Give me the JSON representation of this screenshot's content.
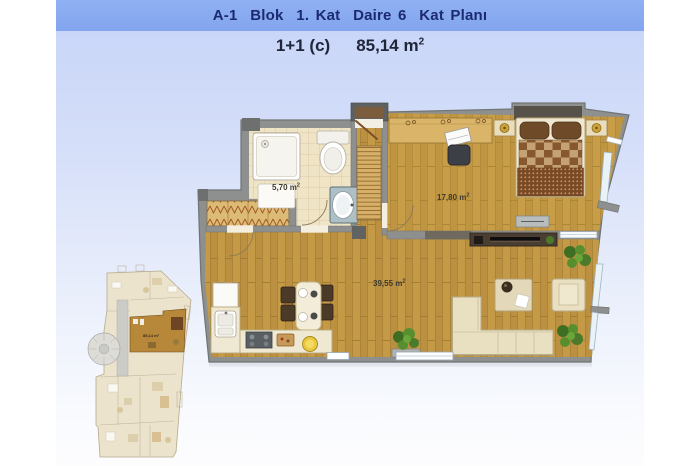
{
  "header": {
    "title": "A-1  Blok  1. Kat  Daire 6  Kat Planı",
    "unit_type": "1+1 (c)",
    "unit_area": "85,14 m",
    "sup": "2"
  },
  "plan": {
    "sup": "2",
    "rooms": {
      "bathroom": {
        "area": "5,70 m"
      },
      "bedroom": {
        "area": "17,80 m"
      },
      "living": {
        "area": "39,55 m"
      }
    }
  },
  "overview": {
    "unit_label": "85,14 m²"
  },
  "colors": {
    "title_band": "#86a7ef",
    "title_text": "#1c2a70",
    "panel_top": "#c6d4f8",
    "wall_gray": "#8d908e",
    "wall_dark": "#5e6160",
    "wood_floor": "#c49a46",
    "tile_floor": "#f0e4c6",
    "furniture_cream": "#e9e0c2",
    "bed_brown": "#875830",
    "plant_green": "#578f2e",
    "highlight_unit": "#b8883a"
  }
}
